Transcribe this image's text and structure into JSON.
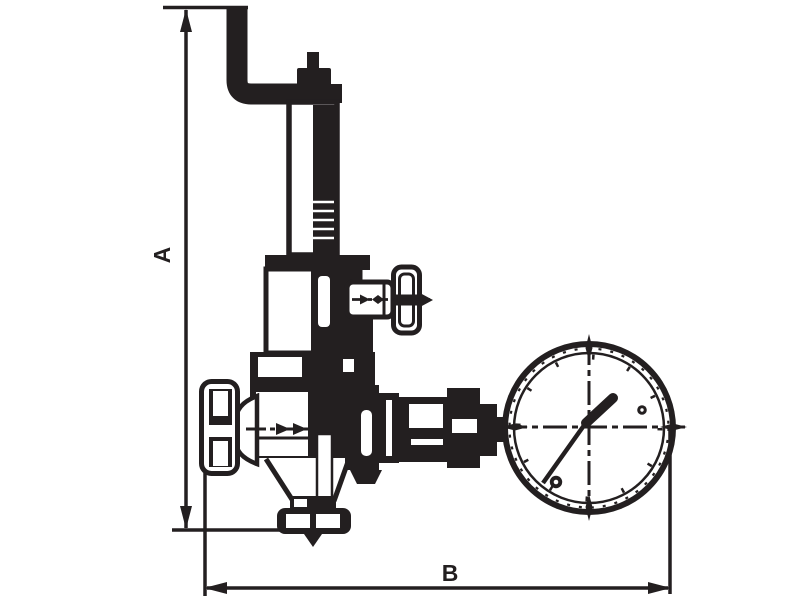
{
  "page": {
    "background_color": "#ffffff",
    "ink_color": "#231f20",
    "description": "Technical line drawing of a pressure reducing valve with spring housing, side shut-off handwheel, left handwheel, bottom drain and pressure gauge"
  },
  "dimensions": {
    "vertical": {
      "label": "A"
    },
    "horizontal": {
      "label": "B"
    }
  }
}
